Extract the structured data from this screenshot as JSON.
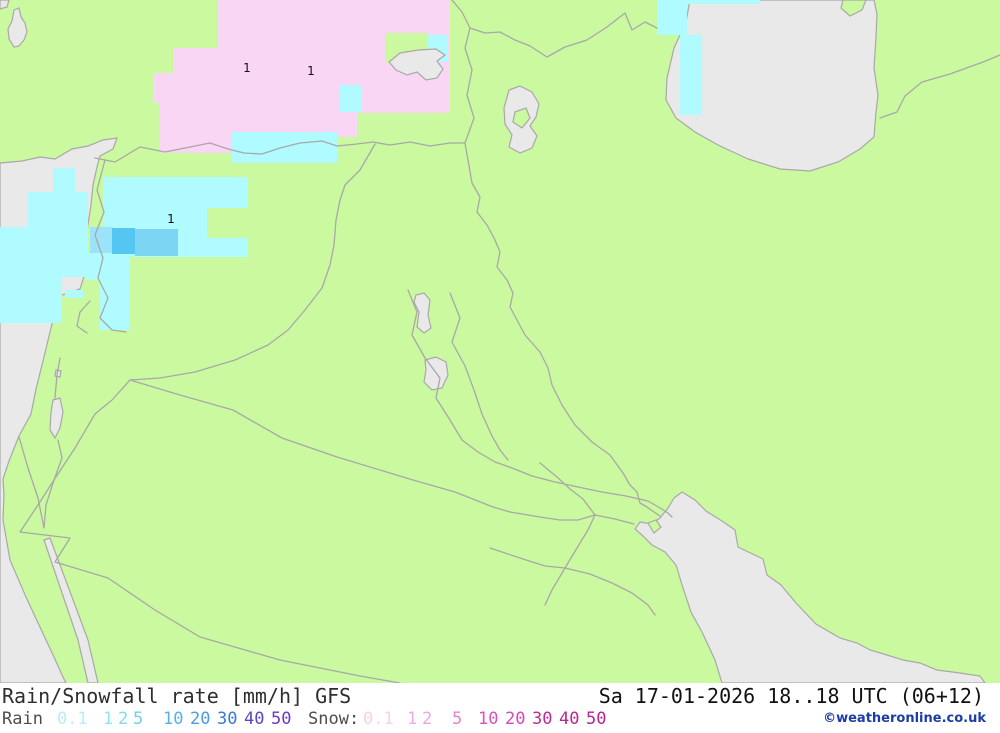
{
  "title_bar": {
    "product": "Rain/Snowfall rate [mm/h] GFS",
    "datetime": "Sa 17-01-2026 18..18 UTC (06+12)"
  },
  "copyright": "©weatheronline.co.uk",
  "legend": {
    "rain_label": "Rain",
    "snow_label": "Snow:",
    "rain_levels": [
      {
        "label": "0.1",
        "x": 57,
        "color": "#b7edf8"
      },
      {
        "label": "1",
        "x": 103,
        "color": "#93e2f4"
      },
      {
        "label": "2",
        "x": 118,
        "color": "#84daf2"
      },
      {
        "label": "5",
        "x": 133,
        "color": "#6fcfee"
      },
      {
        "label": "10",
        "x": 163,
        "color": "#57b0e6"
      },
      {
        "label": "20",
        "x": 190,
        "color": "#4a9de2"
      },
      {
        "label": "30",
        "x": 217,
        "color": "#3b78d8"
      },
      {
        "label": "40",
        "x": 244,
        "color": "#5c45cd"
      },
      {
        "label": "50",
        "x": 271,
        "color": "#6c38c4"
      }
    ],
    "snow_levels": [
      {
        "label": "0.1",
        "x": 363,
        "color": "#f7d0ee"
      },
      {
        "label": "1",
        "x": 407,
        "color": "#f0abdf"
      },
      {
        "label": "2",
        "x": 422,
        "color": "#efa6de"
      },
      {
        "label": "5",
        "x": 452,
        "color": "#e781d1"
      },
      {
        "label": "10",
        "x": 478,
        "color": "#dc52b8"
      },
      {
        "label": "20",
        "x": 505,
        "color": "#d848b0"
      },
      {
        "label": "30",
        "x": 532,
        "color": "#bf2b94"
      },
      {
        "label": "40",
        "x": 559,
        "color": "#bb2790"
      },
      {
        "label": "50",
        "x": 586,
        "color": "#b92390"
      }
    ]
  },
  "map": {
    "land_color": "#cbf9a0",
    "sea_color": "#e9e9e9",
    "border_color": "#a8a8a8",
    "snow_color": "#fad6f5",
    "rain_color": "#b0fbff",
    "labels": [
      {
        "text": "1",
        "x": 247,
        "y": 72
      },
      {
        "text": "1",
        "x": 311,
        "y": 75
      },
      {
        "text": "1",
        "x": 171,
        "y": 223
      }
    ],
    "precip_cells": [
      {
        "name": "snow-1",
        "x": 218,
        "y": 0,
        "w": 232,
        "h": 113,
        "color": "#fad6f5"
      },
      {
        "name": "snow-2",
        "x": 173,
        "y": 48,
        "w": 45,
        "h": 65,
        "color": "#fad6f5"
      },
      {
        "name": "snow-3",
        "x": 153,
        "y": 73,
        "w": 20,
        "h": 30,
        "color": "#fad6f5"
      },
      {
        "name": "snow-4",
        "x": 160,
        "y": 100,
        "w": 197,
        "h": 37,
        "color": "#fad6f5"
      },
      {
        "name": "snow-5",
        "x": 160,
        "y": 132,
        "w": 72,
        "h": 21,
        "color": "#fad6f5"
      },
      {
        "name": "clear-1",
        "x": 385,
        "y": 33,
        "w": 43,
        "h": 30,
        "color": "#cbf9a0"
      },
      {
        "name": "rain-1",
        "x": 428,
        "y": 35,
        "w": 20,
        "h": 27,
        "color": "#b0fbff"
      },
      {
        "name": "rain-2",
        "x": 340,
        "y": 85,
        "w": 22,
        "h": 27,
        "color": "#b0fbff"
      },
      {
        "name": "rain-3",
        "x": 232,
        "y": 132,
        "w": 105,
        "h": 31,
        "color": "#b0fbff"
      },
      {
        "name": "rain-4",
        "x": 657,
        "y": 0,
        "w": 103,
        "h": 4,
        "color": "#b0fbff"
      },
      {
        "name": "rain-5",
        "x": 657,
        "y": 0,
        "w": 30,
        "h": 35,
        "color": "#b0fbff"
      },
      {
        "name": "rain-6",
        "x": 680,
        "y": 35,
        "w": 22,
        "h": 80,
        "color": "#b0fbff"
      },
      {
        "name": "rain-7",
        "x": 53,
        "y": 168,
        "w": 22,
        "h": 26,
        "color": "#b0fbff"
      },
      {
        "name": "rain-8",
        "x": 28,
        "y": 192,
        "w": 60,
        "h": 85,
        "color": "#b0fbff"
      },
      {
        "name": "rain-9",
        "x": 0,
        "y": 227,
        "w": 28,
        "h": 96,
        "color": "#b0fbff"
      },
      {
        "name": "rain-10",
        "x": 103,
        "y": 177,
        "w": 145,
        "h": 80,
        "color": "#b0fbff"
      },
      {
        "name": "rain-11",
        "x": 85,
        "y": 252,
        "w": 45,
        "h": 28,
        "color": "#b0fbff"
      },
      {
        "name": "rain-12",
        "x": 100,
        "y": 280,
        "w": 30,
        "h": 50,
        "color": "#b0fbff"
      },
      {
        "name": "rain-13",
        "x": 13,
        "y": 277,
        "w": 49,
        "h": 46,
        "color": "#b0fbff"
      },
      {
        "name": "rain-14",
        "x": 65,
        "y": 290,
        "w": 18,
        "h": 8,
        "color": "#b0fbff"
      },
      {
        "name": "clear-2",
        "x": 207,
        "y": 208,
        "w": 41,
        "h": 30,
        "color": "#cbf9a0"
      },
      {
        "name": "rain-b1",
        "x": 90,
        "y": 227,
        "w": 23,
        "h": 26,
        "color": "#9ae3f8"
      },
      {
        "name": "rain-b2",
        "x": 112,
        "y": 228,
        "w": 23,
        "h": 26,
        "color": "#55c6f1"
      },
      {
        "name": "rain-b3",
        "x": 135,
        "y": 229,
        "w": 43,
        "h": 27,
        "color": "#7dd5f4"
      }
    ]
  }
}
